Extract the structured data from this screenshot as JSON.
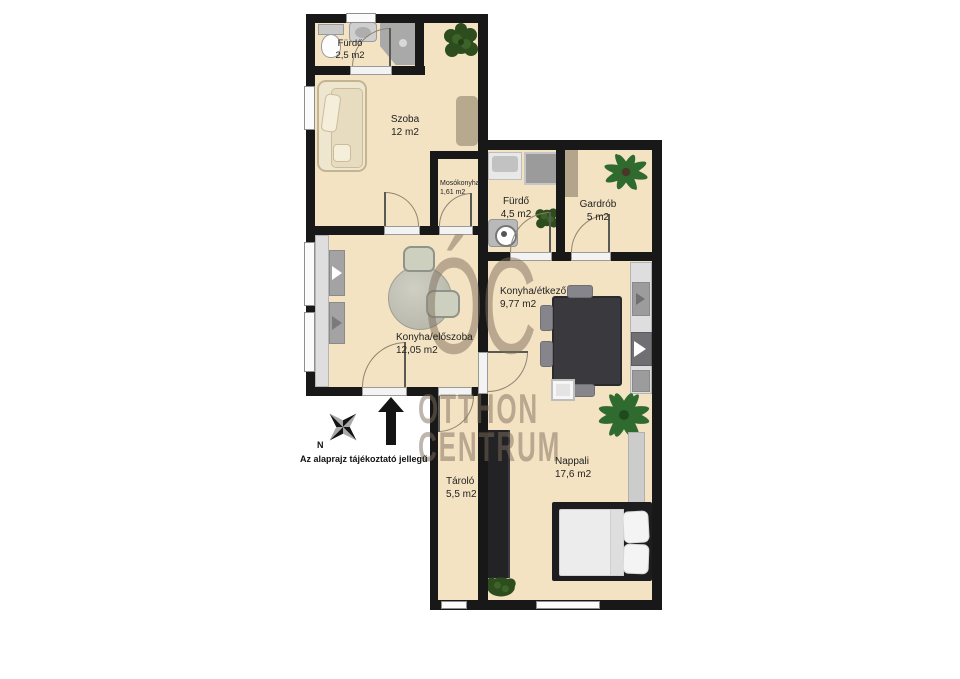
{
  "title": "Apartment floor plan",
  "colors": {
    "floor": "#f4e3c3",
    "wall": "#181818",
    "watermark": "#7d6e5c",
    "plant_dark": "#2e4d1f",
    "plant_palm": "#2f6b2f",
    "wood_accent": "#b3a58c",
    "bed_frame": "#1d1d20",
    "table_dark": "#3a3a3e"
  },
  "rooms": [
    {
      "id": "furdo-small",
      "name": "Fürdő",
      "area": "2,5 m2"
    },
    {
      "id": "szoba",
      "name": "Szoba",
      "area": "12 m2"
    },
    {
      "id": "mosokonyha",
      "name": "Mosókonyha",
      "area": "1,61 m2"
    },
    {
      "id": "furdo-large",
      "name": "Fürdő",
      "area": "4,5 m2"
    },
    {
      "id": "gardrob",
      "name": "Gardrób",
      "area": "5 m2"
    },
    {
      "id": "konyha-etkezo",
      "name": "Konyha/étkező",
      "area": "9,77 m2"
    },
    {
      "id": "konyha-eloszoba",
      "name": "Konyha/előszoba",
      "area": "12,05 m2"
    },
    {
      "id": "nappali",
      "name": "Nappali",
      "area": "17,6 m2"
    },
    {
      "id": "tarolo",
      "name": "Tároló",
      "area": "5,5 m2"
    }
  ],
  "watermark": {
    "monogram": "ÓC",
    "line1": "OTTHON",
    "line2": "CENTRUM"
  },
  "annotations": {
    "disclaimer": "Az alaprajz tájékoztató jellegű",
    "compass_label": "N"
  }
}
